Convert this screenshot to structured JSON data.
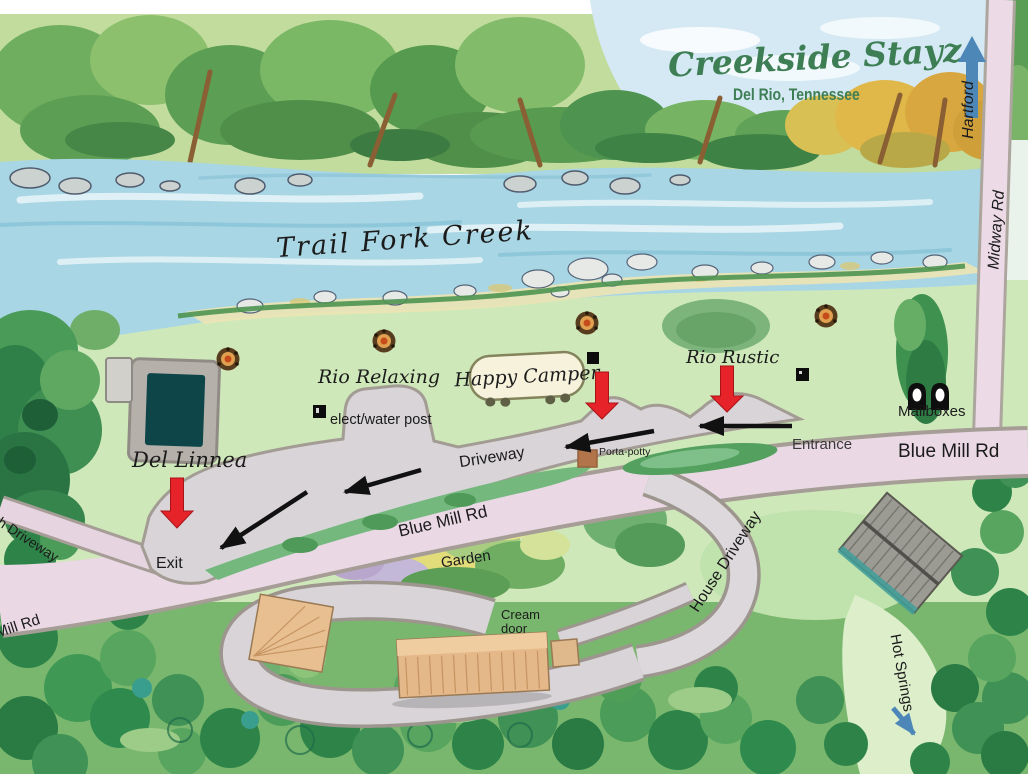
{
  "header": {
    "title": "Creekside Stayz",
    "subtitle": "Del Rio, Tennessee"
  },
  "creek": {
    "name": "Trail Fork Creek"
  },
  "roads": {
    "midway": "Midway Rd",
    "hartford": "Hartford",
    "blue_mill_east": "Blue Mill Rd",
    "blue_mill_center": "Blue Mill Rd",
    "mill_rd_west": "Mill Rd",
    "church_driveway": "ch Driveway",
    "house_driveway": "House Driveway",
    "internal_driveway": "Driveway",
    "hot_springs": "Hot Springs"
  },
  "access": {
    "entrance": "Entrance",
    "exit": "Exit"
  },
  "sites": {
    "rio_relaxing": "Rio Relaxing",
    "rio_rustic": "Rio Rustic",
    "happy_camper": "Happy Camper",
    "del_linnea": "Del Linnea",
    "mailboxes": "Mailboxes",
    "elect_water_post": "elect/water post",
    "porta_potty": "Porta-potty",
    "garden": "Garden",
    "cream_door": "Cream door"
  },
  "colors": {
    "title_green": "#3e7e55",
    "arrow_red": "#e52329",
    "arrow_blue": "#4d87b8",
    "road_pink": "#ead8e4",
    "driveway_gray": "#d8d4d8",
    "river_blue": "#a9d6e4",
    "pool_teal": "#0d4549"
  }
}
